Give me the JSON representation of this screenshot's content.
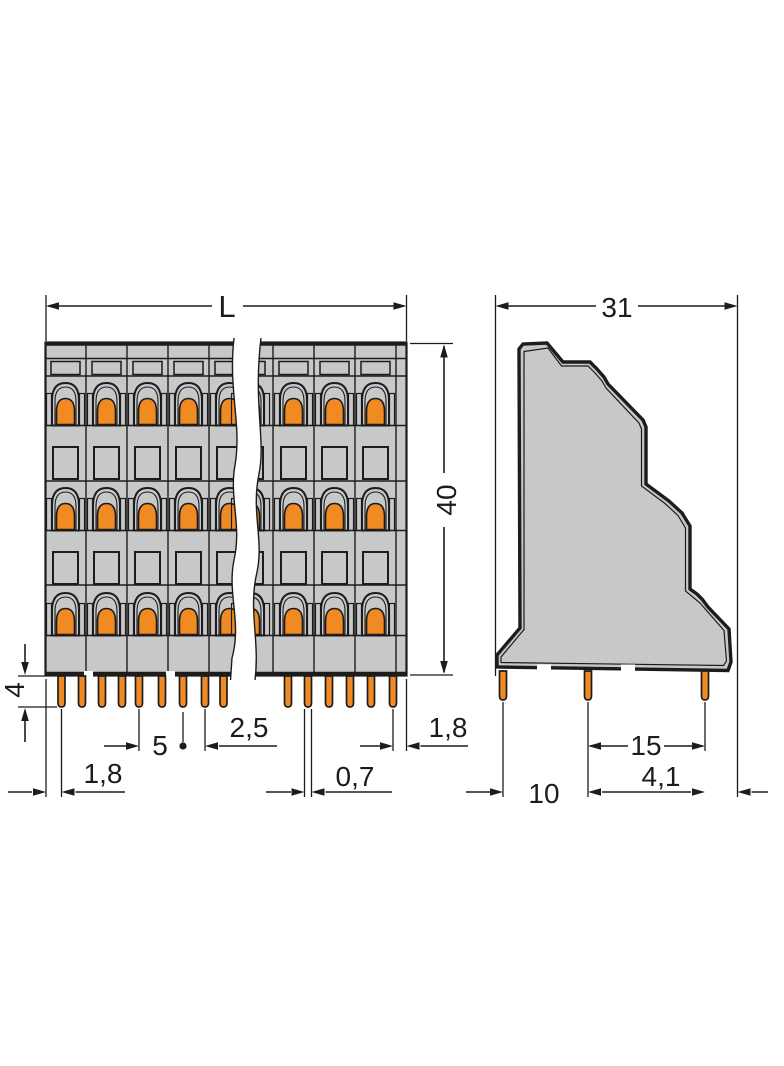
{
  "drawing": {
    "type": "technical-dimension-drawing",
    "subject": "triple-level pcb terminal block",
    "front_view": {
      "dims": {
        "length": "L",
        "height": "40",
        "pin_length": "4",
        "edge_to_first_pin": "1,8",
        "pole_pitch": "5",
        "pin_pair_spacing": "2,5",
        "pin_width": "0,7",
        "last_pin_to_edge": "1,8"
      },
      "levels": 3,
      "visible_modules_left": 6,
      "visible_modules_right": 3,
      "visible_pins_left": 9,
      "visible_pins_right": 6
    },
    "side_view": {
      "dims": {
        "depth": "31",
        "pin_row_spacing": "15",
        "pin_to_edge": "4,1",
        "first_pin_offset": "10"
      },
      "visible_pins": 3
    },
    "colors": {
      "body": "#c7c8c8",
      "line": "#1c1c1c",
      "contact": "#f08a23",
      "background": "#ffffff"
    }
  }
}
